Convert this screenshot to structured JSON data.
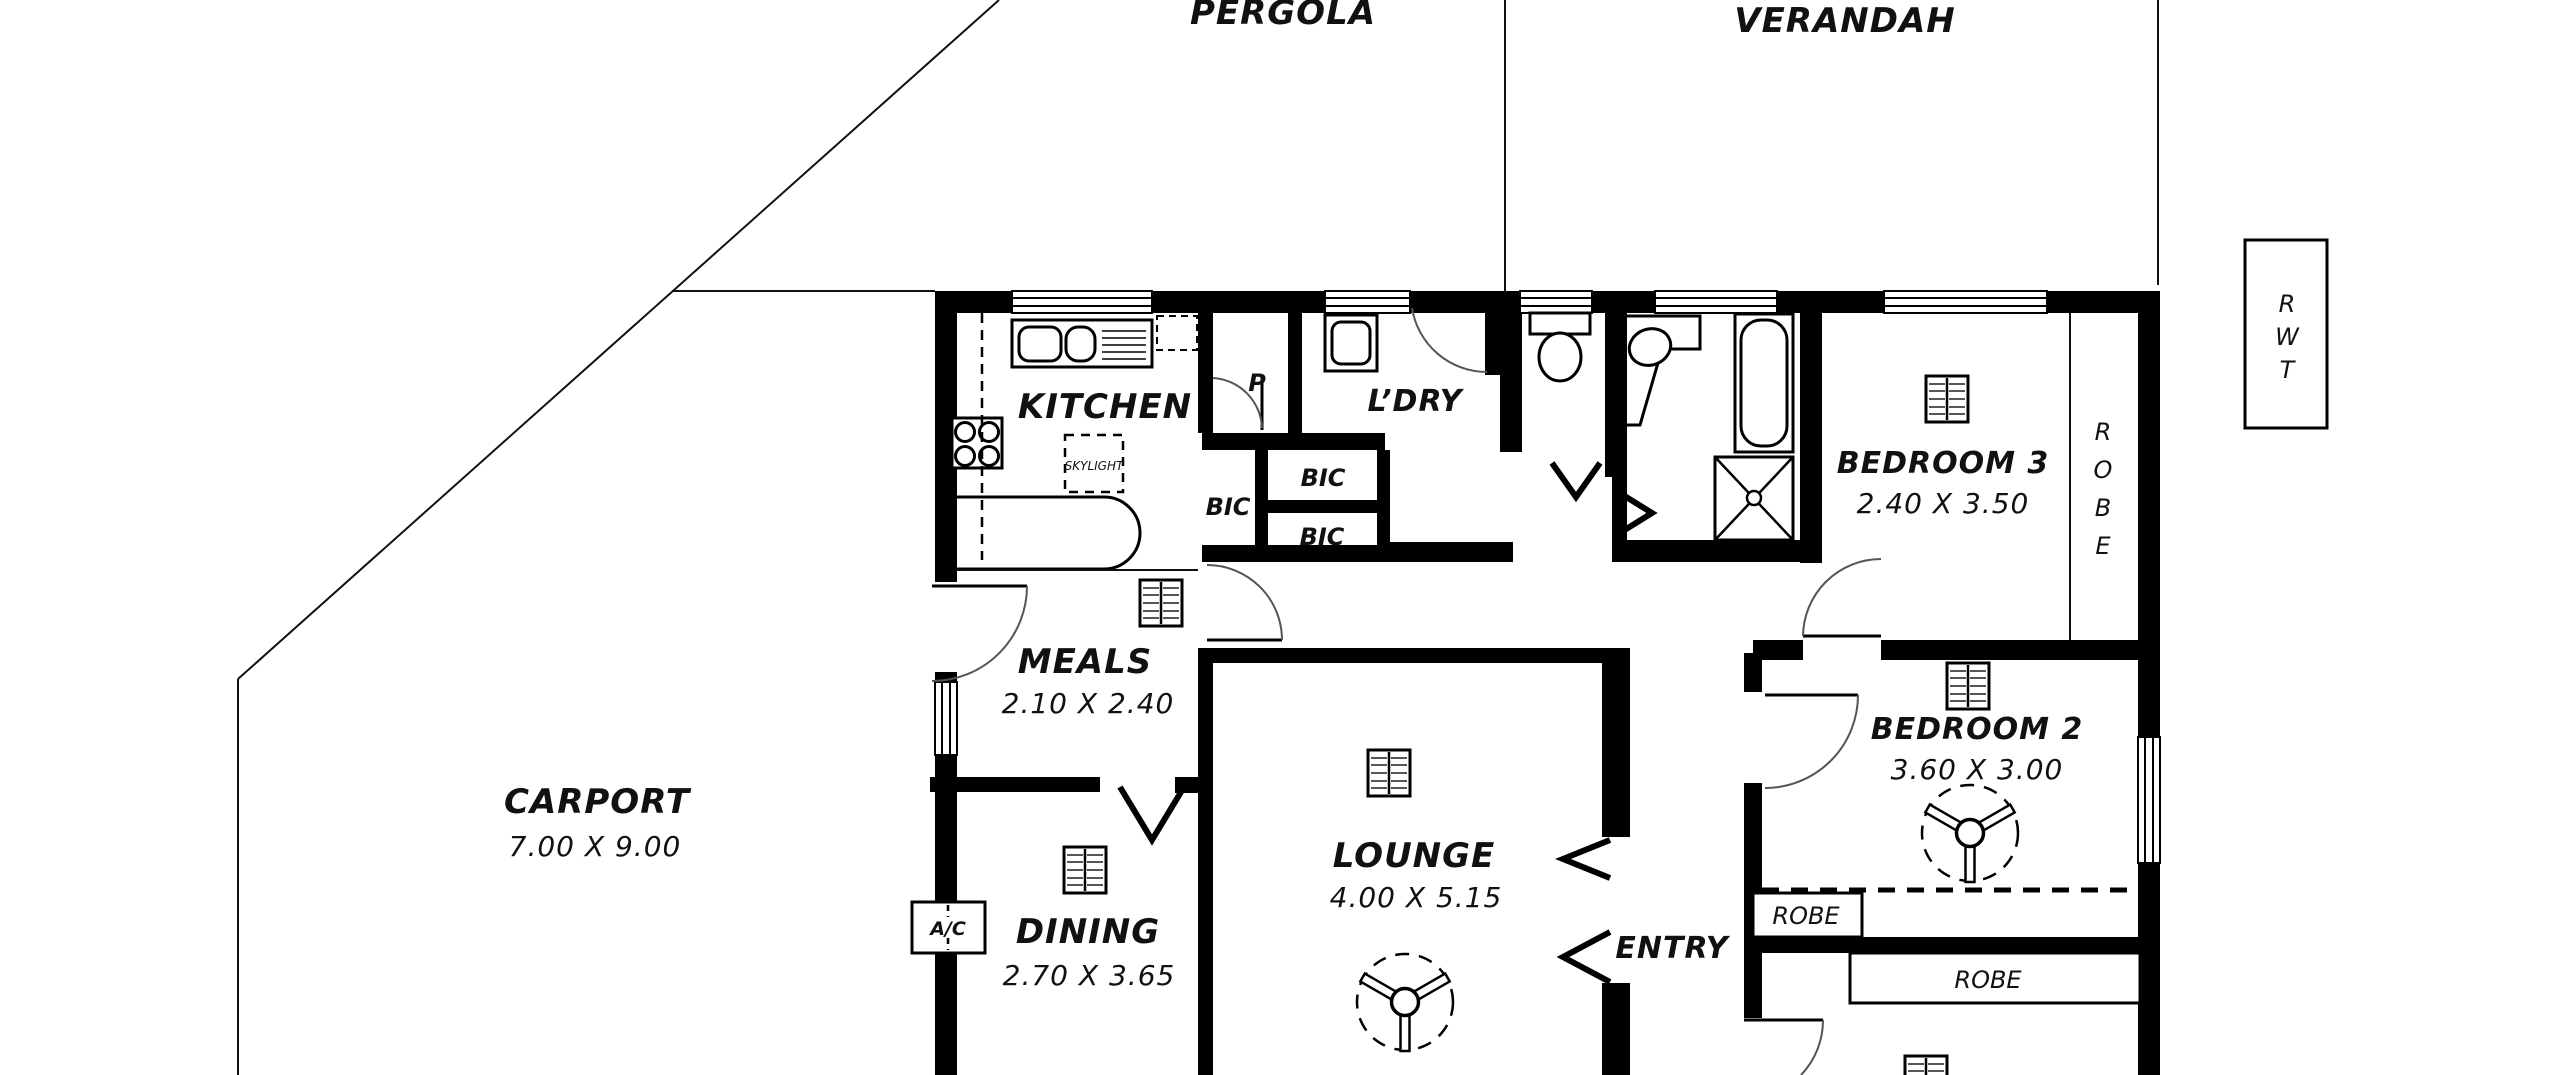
{
  "plan": {
    "outdoor": {
      "pergola": "PERGOLA",
      "verandah": "VERANDAH",
      "carport": {
        "name": "CARPORT",
        "dims": "7.00 X 9.00"
      },
      "rwt_letters": [
        "R",
        "W",
        "T"
      ]
    },
    "rooms": {
      "kitchen": {
        "name": "KITCHEN"
      },
      "meals": {
        "name": "MEALS",
        "dims": "2.10 X 2.40"
      },
      "dining": {
        "name": "DINING",
        "dims": "2.70 X 3.65"
      },
      "lounge": {
        "name": "LOUNGE",
        "dims": "4.00 X 5.15"
      },
      "entry": {
        "name": "ENTRY"
      },
      "laundry": {
        "name": "L’DRY"
      },
      "bedroom3": {
        "name": "BEDROOM 3",
        "dims": "2.40 X 3.50"
      },
      "bedroom2": {
        "name": "BEDROOM 2",
        "dims": "3.60 X 3.00"
      }
    },
    "labels": {
      "pantry": "P",
      "bic_left": "BIC",
      "bic_top": "BIC",
      "bic_bottom": "BIC",
      "skylight": "SKYLIGHT",
      "ac_unit": "A/C",
      "robe_box_bed2": "ROBE",
      "robe_box_lower": "ROBE",
      "robe_vertical_letters": [
        "R",
        "O",
        "B",
        "E"
      ]
    }
  }
}
